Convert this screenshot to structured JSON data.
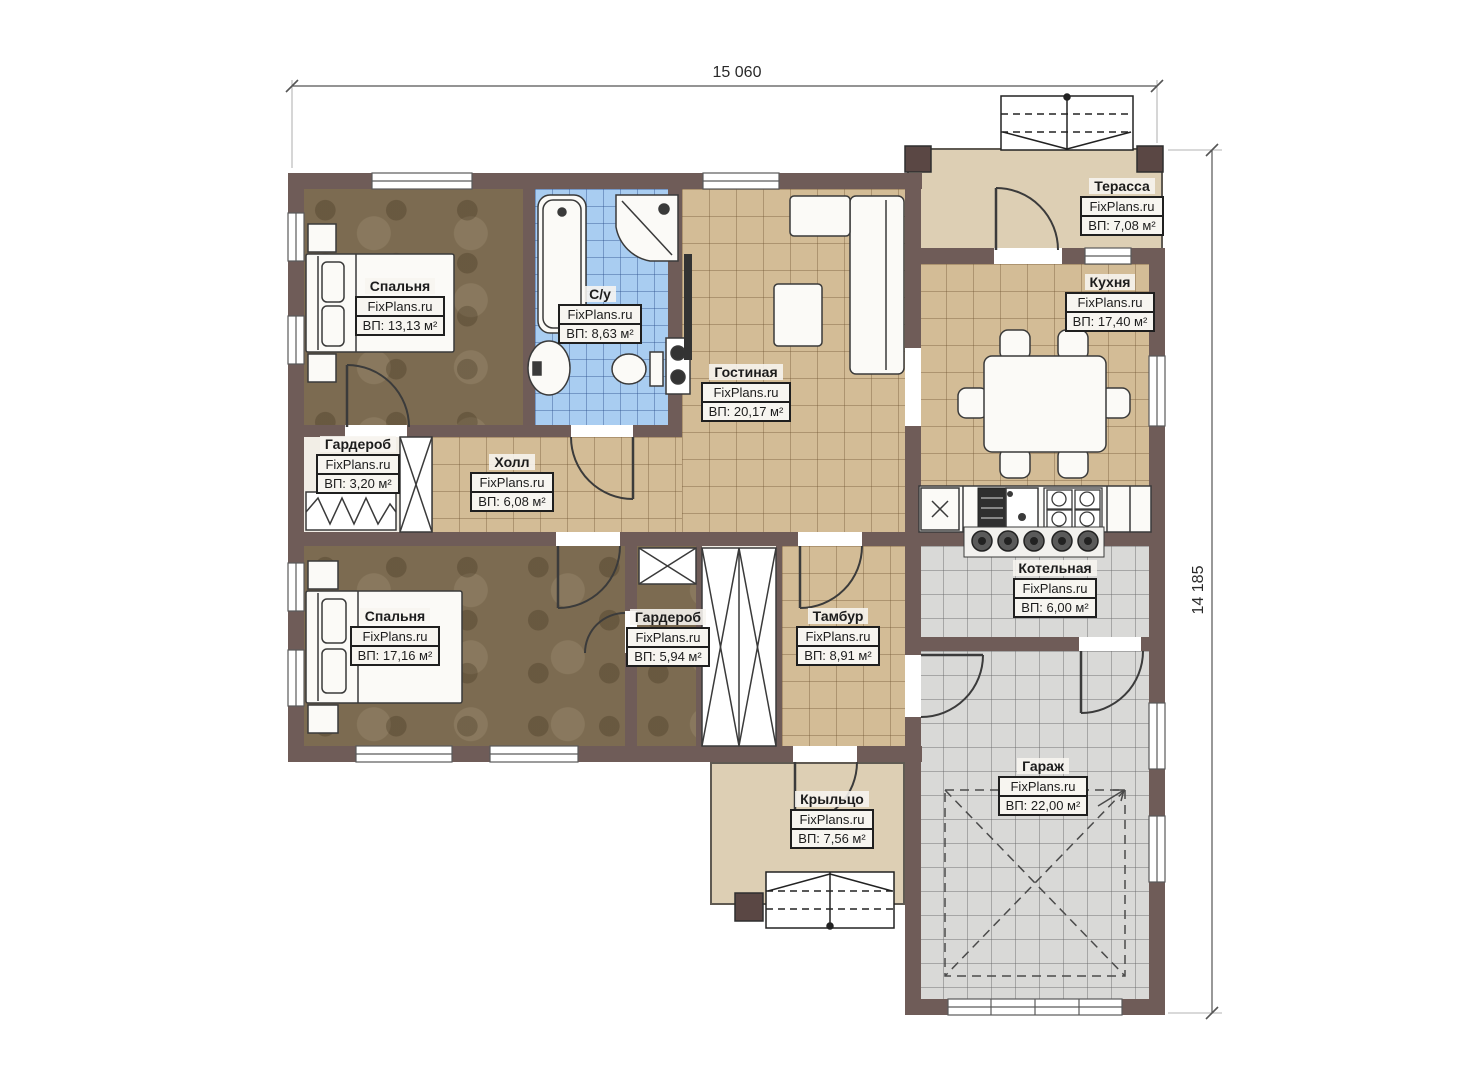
{
  "plan": {
    "brand": "FixPlans.ru",
    "dim_width": "15 060",
    "dim_height": "14 185",
    "rooms": [
      {
        "id": "bedroom1",
        "name": "Спальня",
        "area": "ВП: 13,13 м²"
      },
      {
        "id": "bathroom",
        "name": "С/у",
        "area": "ВП: 8,63 м²"
      },
      {
        "id": "wardrobe1",
        "name": "Гардероб",
        "area": "ВП: 3,20 м²"
      },
      {
        "id": "hall",
        "name": "Холл",
        "area": "ВП: 6,08 м²"
      },
      {
        "id": "living",
        "name": "Гостиная",
        "area": "ВП: 20,17 м²"
      },
      {
        "id": "kitchen",
        "name": "Кухня",
        "area": "ВП: 17,40 м²"
      },
      {
        "id": "terrace",
        "name": "Терасса",
        "area": "ВП: 7,08 м²"
      },
      {
        "id": "bedroom2",
        "name": "Спальня",
        "area": "ВП: 17,16 м²"
      },
      {
        "id": "wardrobe2",
        "name": "Гардероб",
        "area": "ВП: 5,94 м²"
      },
      {
        "id": "tambour",
        "name": "Тамбур",
        "area": "ВП: 8,91 м²"
      },
      {
        "id": "boiler",
        "name": "Котельная",
        "area": "ВП: 6,00 м²"
      },
      {
        "id": "garage",
        "name": "Гараж",
        "area": "ВП: 22,00 м²"
      },
      {
        "id": "porch",
        "name": "Крыльцо",
        "area": "ВП: 7,56 м²"
      }
    ],
    "colors": {
      "wall": "#6f5c58",
      "column": "#5a4744",
      "floor_wood": "#7c6b51",
      "tile_tan": "#d3bc96",
      "tile_blue": "#a9cdf1",
      "tile_gray": "#d9d9d7",
      "deck_beige": "#ddcfb4",
      "fixture_white": "#fbfaf7"
    }
  }
}
